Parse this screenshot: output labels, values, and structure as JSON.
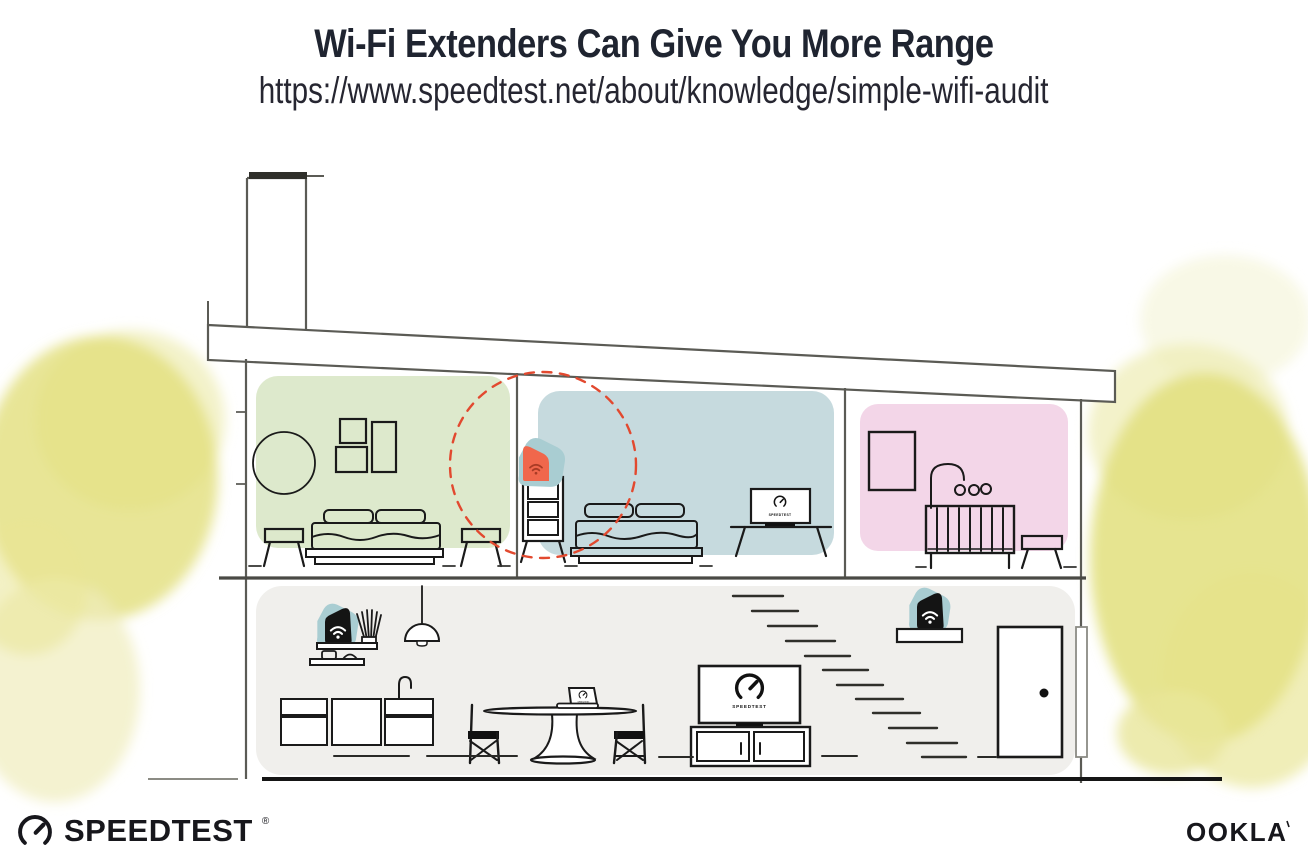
{
  "header": {
    "title": "Wi-Fi Extenders Can Give You More Range",
    "url": "https://www.speedtest.net/about/knowledge/simple-wifi-audit"
  },
  "scene": {
    "tv_bedroom_label": "SPEEDTEST",
    "tv_living_label": "SPEEDTEST",
    "laptop_label": "SPEEDTEST",
    "rooms": [
      {
        "name": "bedroom-left",
        "color": "#DDE9CC"
      },
      {
        "name": "bedroom-middle",
        "color": "#C6DADE"
      },
      {
        "name": "nursery",
        "color": "#F3D6E8"
      },
      {
        "name": "ground-floor",
        "color": "#F0EFEC"
      }
    ],
    "devices": [
      {
        "name": "wifi-extender",
        "accent": "#F0674C",
        "highlight_circle": "#E2492F"
      },
      {
        "name": "wifi-router-kitchen",
        "accent": "#141414"
      },
      {
        "name": "wifi-router-entry",
        "accent": "#141414"
      }
    ],
    "colors": {
      "device_pad_teal": "#A9CDD2",
      "foliage_yellow": "#E2DF7C",
      "wall_gray": "#5B5B55",
      "ink": "#1A1A1A"
    }
  },
  "footer": {
    "speedtest_label": "SPEEDTEST",
    "speedtest_reg": "®",
    "ookla_label": "OOKLA"
  }
}
